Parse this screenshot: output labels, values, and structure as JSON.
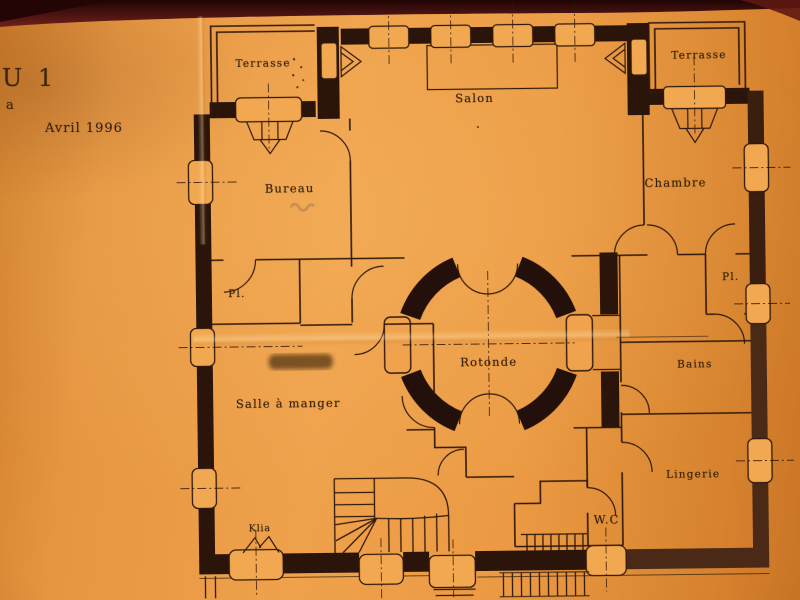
{
  "photo": {
    "header_note": {
      "title_fragment": "U 1",
      "letter_fragment": "a",
      "date": "Avril 1996"
    },
    "room_labels": {
      "terrasse_left": "Terrasse",
      "terrasse_right": "Terrasse",
      "salon": "Salon",
      "bureau": "Bureau",
      "chambre": "Chambre",
      "closet_left": "Pl.",
      "closet_right": "Pl.",
      "rotonde": "Rotonde",
      "salle_a_manger": "Salle à manger",
      "bains": "Bains",
      "lingerie": "Lingerie",
      "wc": "W.C",
      "klia": "Klia"
    },
    "colors": {
      "paper": "#ec9c44",
      "paper_edge": "#c97526",
      "ink": "#30190b",
      "wall_fill": "#2b140a",
      "wall_fill_faded": "#4a2a16",
      "background_band": "#4c100d"
    }
  }
}
